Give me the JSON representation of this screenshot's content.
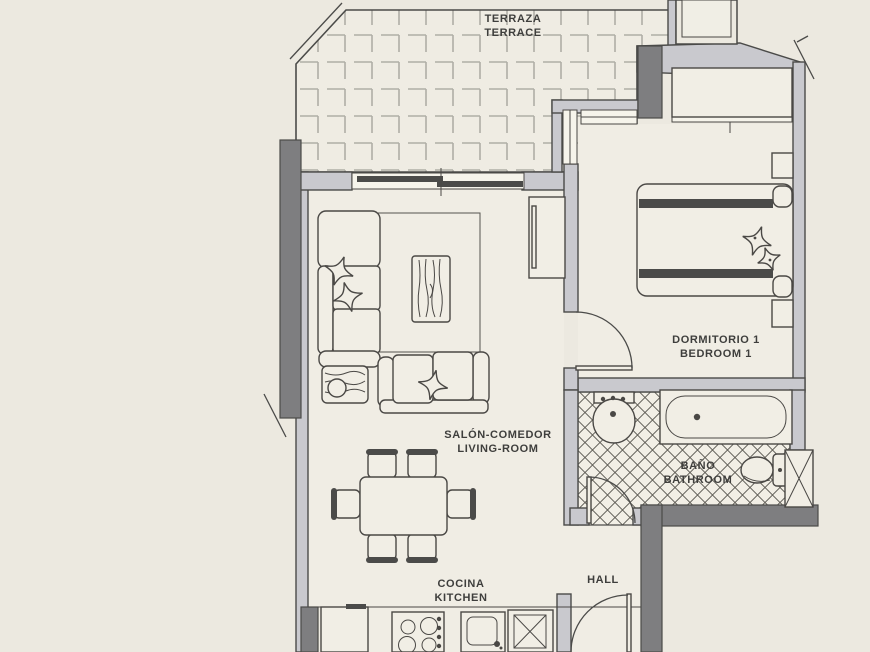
{
  "plan": {
    "type": "apartment-floor-plan",
    "width_px": 870,
    "height_px": 652
  },
  "rooms": {
    "terrace": {
      "lines": [
        "TERRAZA",
        "TERRACE"
      ]
    },
    "living_room": {
      "lines": [
        "SALÓN-COMEDOR",
        "LIVING-ROOM"
      ]
    },
    "kitchen": {
      "lines": [
        "COCINA",
        "KITCHEN"
      ]
    },
    "bedroom1": {
      "lines": [
        "DORMITORIO 1",
        "BEDROOM 1"
      ]
    },
    "bathroom": {
      "lines": [
        "BAÑO",
        "BATHROOM"
      ]
    },
    "hall": {
      "lines": [
        "HALL"
      ]
    }
  },
  "palette": {
    "background": "#ECE9E0",
    "floor": "#F0EDE4",
    "wall_light": "#C9C9CE",
    "wall_dark": "#7E7E80",
    "outline": "#4B4B49",
    "terrace_tile_line": "#AFAEA6",
    "bath_tile_line": "#5E5C55",
    "bed_stripe": "#5A5A58",
    "label_text": "#3E3E3C"
  },
  "icons": [
    "corner-sofa-icon",
    "two-seat-sofa-icon",
    "star-cushion-icon",
    "rug-icon",
    "coffee-table-icon",
    "side-table-lamp-icon",
    "tv-cabinet-icon",
    "dining-table-icon",
    "dining-chair-icon",
    "double-bed-icon",
    "nightstand-icon",
    "wardrobe-icon",
    "bathtub-icon",
    "washbasin-icon",
    "toilet-icon",
    "utility-shaft-icon",
    "fridge-icon",
    "hob-icon",
    "kitchen-sink-icon",
    "washing-machine-icon",
    "door-swing-icon",
    "sliding-window-icon",
    "wall-break-tick-icon"
  ]
}
